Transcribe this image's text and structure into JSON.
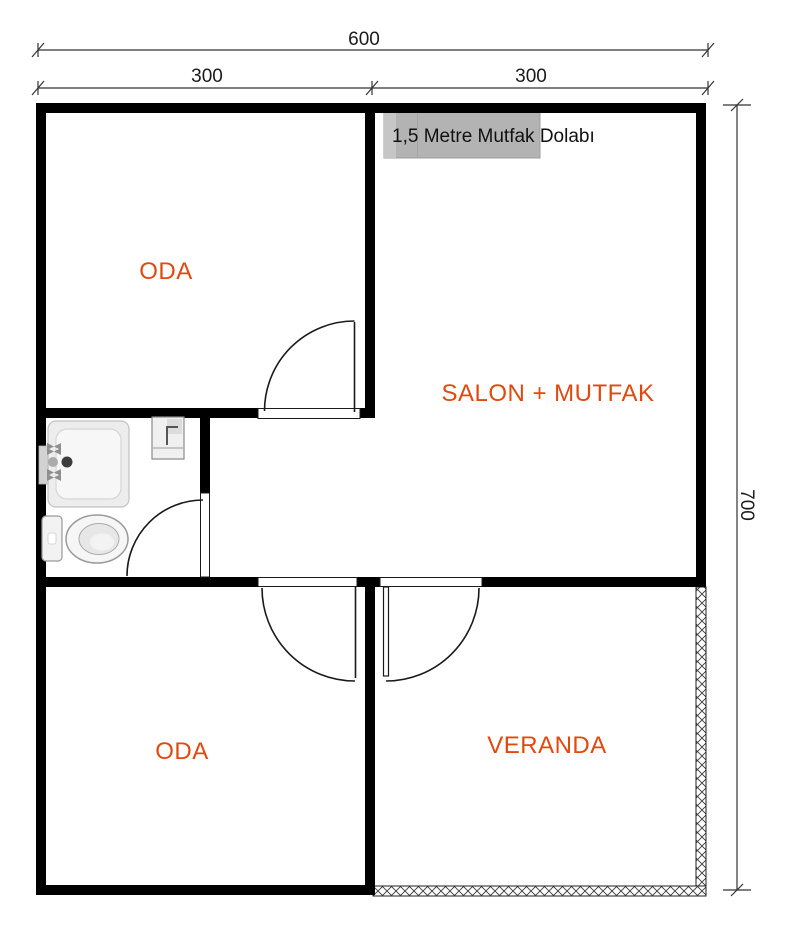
{
  "plan": {
    "dimensions": {
      "total_width_label": "600",
      "left_span_label": "300",
      "right_span_label": "300",
      "height_label": "700"
    },
    "rooms": {
      "top_left": {
        "label": "ODA"
      },
      "salon": {
        "label": "SALON + MUTFAK"
      },
      "bottom_left": {
        "label": "ODA"
      },
      "veranda": {
        "label": "VERANDA"
      }
    },
    "annotations": {
      "kitchen_cabinet": "1,5 Metre Mutfak Dolabı"
    },
    "fixtures": [
      "shower-tray",
      "toilet",
      "washbasin",
      "kitchen-cabinet"
    ],
    "colors": {
      "wall": "#000000",
      "room_label": "#e2490f",
      "cabinet_fill": "#b3b3b3",
      "dimension_text": "#1a1a1a"
    }
  }
}
